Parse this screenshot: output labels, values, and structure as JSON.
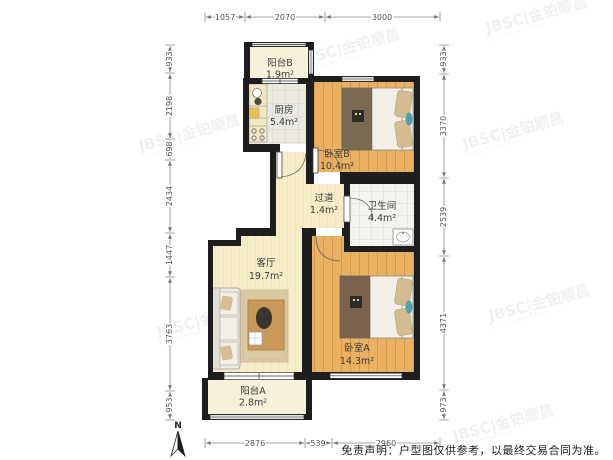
{
  "plan": {
    "rooms": [
      {
        "id": "balcony-b",
        "name": "阳台B",
        "area": "1.9m²"
      },
      {
        "id": "kitchen",
        "name": "厨房",
        "area": "5.4m²"
      },
      {
        "id": "bedroom-b",
        "name": "卧室B",
        "area": "10.4m²"
      },
      {
        "id": "hallway",
        "name": "过道",
        "area": "1.4m²"
      },
      {
        "id": "bathroom",
        "name": "卫生间",
        "area": "4.4m²"
      },
      {
        "id": "living",
        "name": "客厅",
        "area": "19.7m²"
      },
      {
        "id": "bedroom-a",
        "name": "卧室A",
        "area": "14.3m²"
      },
      {
        "id": "balcony-a",
        "name": "阳台A",
        "area": "2.8m²"
      }
    ],
    "dimensions_mm": {
      "top": [
        "1057",
        "2070",
        "3000"
      ],
      "bottom": [
        "2876",
        "539",
        "2960"
      ],
      "left": [
        "933",
        "2198",
        "698",
        "2434",
        "1447",
        "3763",
        "953"
      ],
      "right": [
        "933",
        "3370",
        "2539",
        "4371",
        "973"
      ]
    },
    "compass_label": "N"
  },
  "watermark": {
    "full": "JBSC|金铂顺昌",
    "sub": "ASSET MANAGEMENT"
  },
  "disclaimer": "免责声明：户型图仅供参考，以最终交易合同为准。",
  "colors": {
    "wall": "#1d1d1d",
    "wood_floor": "#eab162",
    "living_floor": "#f7ecc8",
    "kitchen_floor": "#eae9e4",
    "bath_floor": "#f4f4f0",
    "balcony_floor": "#f5f1da",
    "dim_line": "#8a8a8a",
    "bed_runner": "#7b6b54",
    "pillow": "#d3bd90",
    "accent_teal": "#4fa3ad",
    "rug": "#dbc9a2",
    "table_wood": "#c9995a"
  }
}
